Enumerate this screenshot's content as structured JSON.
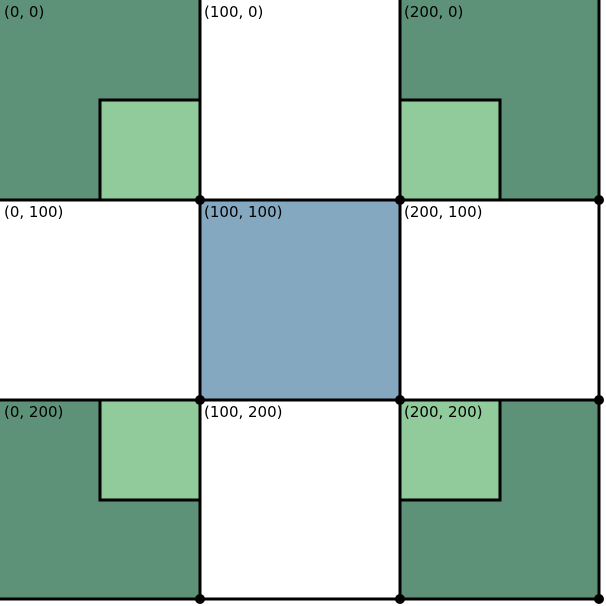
{
  "figure": {
    "colors": {
      "dark_green": "#5D9279",
      "light_green": "#91CA9B",
      "blue": "#84A8BF",
      "white": "#FFFFFF",
      "line": "#000000",
      "dot": "#000000",
      "label_text": "#000000",
      "background": "#FFFFFF"
    },
    "cells": [
      {
        "label": "(0, 0)",
        "fill": "#5D9279"
      },
      {
        "label": "(100, 0)",
        "fill": "#FFFFFF"
      },
      {
        "label": "(200, 0)",
        "fill": "#5D9279"
      },
      {
        "label": "(0, 100)",
        "fill": "#FFFFFF"
      },
      {
        "label": "(100, 100)",
        "fill": "#84A8BF"
      },
      {
        "label": "(200, 100)",
        "fill": "#FFFFFF"
      },
      {
        "label": "(0, 200)",
        "fill": "#5D9279"
      },
      {
        "label": "(100, 200)",
        "fill": "#FFFFFF"
      },
      {
        "label": "(200, 200)",
        "fill": "#5D9279"
      }
    ],
    "inner_squares": [
      {
        "parent": "(0, 0)",
        "corner": "bottom-right",
        "fill": "#91CA9B"
      },
      {
        "parent": "(200, 0)",
        "corner": "bottom-left",
        "fill": "#91CA9B"
      },
      {
        "parent": "(0, 200)",
        "corner": "top-right",
        "fill": "#91CA9B"
      },
      {
        "parent": "(200, 200)",
        "corner": "top-left",
        "fill": "#91CA9B"
      }
    ],
    "points": [
      {
        "x": 100,
        "y": 100
      },
      {
        "x": 200,
        "y": 100
      },
      {
        "x": 300,
        "y": 100
      },
      {
        "x": 100,
        "y": 200
      },
      {
        "x": 200,
        "y": 200
      },
      {
        "x": 300,
        "y": 200
      },
      {
        "x": 100,
        "y": 300
      },
      {
        "x": 200,
        "y": 300
      },
      {
        "x": 300,
        "y": 300
      }
    ]
  }
}
